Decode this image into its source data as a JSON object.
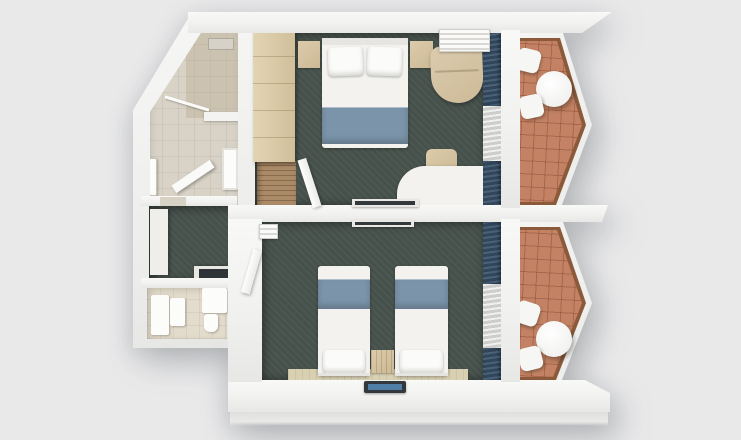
{
  "scene": {
    "title": "3D top-down floor plan render of two hotel rooms",
    "description": "Photoreal top-down 3D rendering: upper double room and lower twin room, each with dark teal carpet, blue window drapes with white sheers, and a hexagonal terracotta-tiled balcony with a round table and two stools; left wing holds a skylit bathroom with shower, a small corridor with kitchenette counter, and a WC."
  },
  "rooms": [
    {
      "id": "double-room",
      "name": "Double bedroom",
      "floor": "dark teal carpet",
      "furniture": [
        "wardrobe",
        "double bed with two pillows and blue runner",
        "left nightstand",
        "right nightstand",
        "air-conditioner grille",
        "beige armchair",
        "white desk with rounded corner",
        "desk chair",
        "wall TV",
        "blue drapes with white sheer",
        "open entry door",
        "wood-slat entry floor"
      ]
    },
    {
      "id": "twin-room",
      "name": "Twin bedroom",
      "floor": "dark teal carpet",
      "furniture": [
        "twin bed 1 with blue runner",
        "twin bed 2 with blue runner",
        "shared nightstand",
        "beige runner rug",
        "flat TV on lower wall",
        "wall TV on upper wall",
        "blue drapes with white sheer",
        "open entry door",
        "small AC box"
      ]
    },
    {
      "id": "bathroom",
      "name": "Bathroom with angled wall",
      "floor": "beige tile",
      "furniture": [
        "shower zone",
        "glass screen",
        "towel rail",
        "open door leaf",
        "vanity sink",
        "divider wall"
      ]
    },
    {
      "id": "corridor",
      "name": "Service corridor",
      "floor": "dark teal carpet",
      "furniture": [
        "white closet",
        "counter with dark hob"
      ]
    },
    {
      "id": "wc",
      "name": "WC",
      "floor": "light beige tile",
      "furniture": [
        "washer unit",
        "cabinet",
        "vanity partition",
        "toilet"
      ]
    },
    {
      "id": "balcony-upper",
      "name": "Upper hexagonal balcony",
      "floor": "terracotta tile",
      "furniture": [
        "round table",
        "stool",
        "stool"
      ]
    },
    {
      "id": "balcony-lower",
      "name": "Lower hexagonal balcony",
      "floor": "terracotta tile",
      "furniture": [
        "round table",
        "stool",
        "stool"
      ]
    }
  ],
  "colors": {
    "bg": "#e9e9ea",
    "carpet": "#47514c",
    "tileBath": "#d9d3c7",
    "tileWc": "#e3dbcb",
    "balTile": "#c28263",
    "balWood": "#8a5a3b",
    "furnWhite": "#f3f2ef",
    "blue": "#7b94a9",
    "curtain": "#4a617a",
    "curtainDark": "#32465a",
    "sheer": "#f0f0ee",
    "sheerDark": "#cdcdcb",
    "rug": "#d9d0b2",
    "tv": "#33383d",
    "tvScreen": "#4f7fa6"
  }
}
